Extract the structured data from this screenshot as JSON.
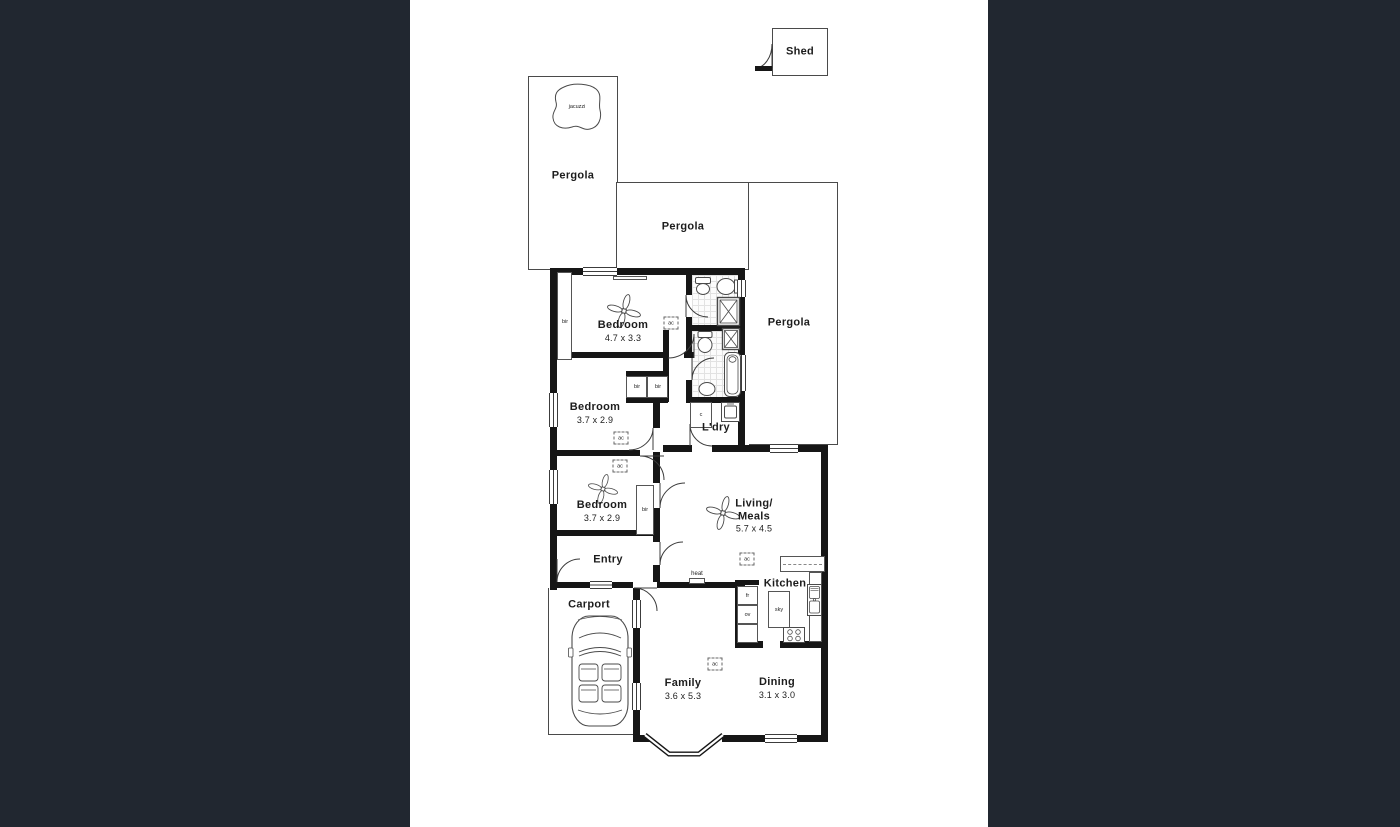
{
  "colors": {
    "sidebar": "#212730",
    "canvas": "#ffffff",
    "wall": "#161616",
    "line": "#4a4a4a",
    "tile_floor": "#fcfcfc"
  },
  "labels": {
    "shed": "Shed",
    "pergola": "Pergola",
    "jacuzzi": "jacuzzi",
    "carport": "Carport",
    "entry": "Entry",
    "kitchen": "Kitchen",
    "laundry": "L'dry",
    "heat": "heat",
    "bir": "bir",
    "ac": "ac",
    "cupboard": "c",
    "fridge": "fr",
    "oven": "ov",
    "skylight": "sky"
  },
  "rooms": {
    "bedroom1": {
      "name": "Bedroom",
      "dims": "4.7 x 3.3"
    },
    "bedroom2": {
      "name": "Bedroom",
      "dims": "3.7 x 2.9"
    },
    "bedroom3": {
      "name": "Bedroom",
      "dims": "3.7 x 2.9"
    },
    "living": {
      "name": "Living/",
      "name2": "Meals",
      "dims": "5.7 x 4.5"
    },
    "family": {
      "name": "Family",
      "dims": "3.6 x 5.3"
    },
    "dining": {
      "name": "Dining",
      "dims": "3.1 x 3.0"
    }
  }
}
